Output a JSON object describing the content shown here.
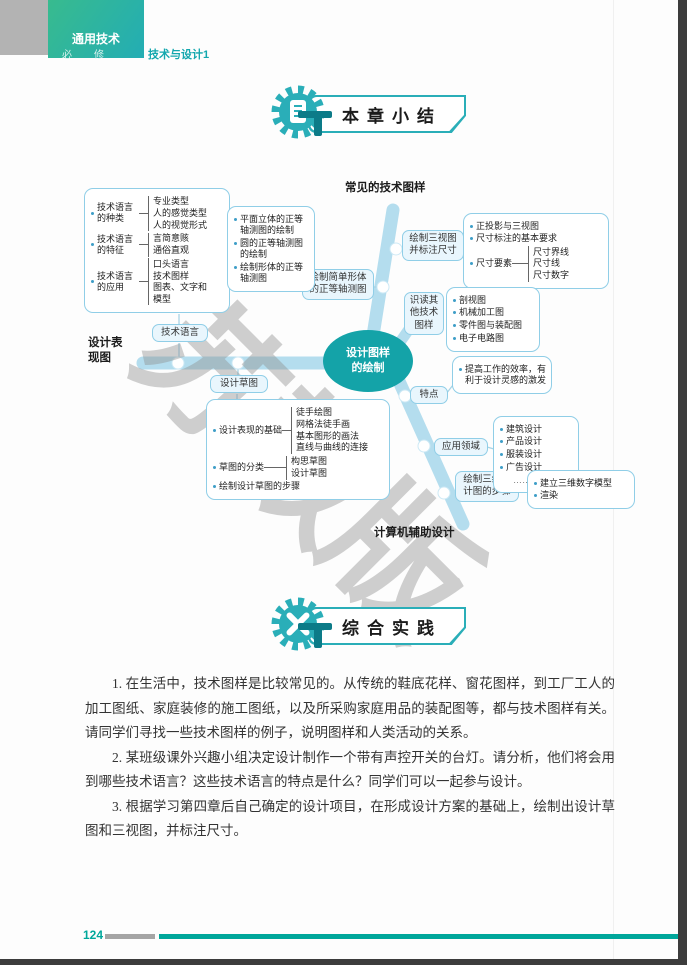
{
  "header": {
    "series": "通用技术",
    "level": "必　修",
    "book": "技术与设计1"
  },
  "badges": {
    "summary": "本章小结",
    "practice": "综合实践"
  },
  "mindmap": {
    "center_line1": "设计图样",
    "center_line2": "的绘制",
    "watermark": "苏教版",
    "labels": {
      "top": "常见的技术图样",
      "left": "设计表现图",
      "bottom": "计算机辅助设计"
    },
    "nodes": {
      "tech_language": "技术语言",
      "sketch": "设计草图",
      "simple_axono": "绘制简单形体的正等轴测图",
      "three_view": "绘制三视图并标注尺寸",
      "read_other": "识读其他技术图样",
      "features": "特点",
      "fields": "应用领域",
      "three_d": "绘制三维设计图的步骤"
    },
    "boxes": {
      "tech_language": {
        "items": [
          {
            "label": "技术语言的种类",
            "subs": [
              "专业类型",
              "人的感觉类型",
              "人的视觉形式"
            ]
          },
          {
            "label": "技术语言的特征",
            "subs": [
              "言简意赅",
              "通俗直观"
            ]
          },
          {
            "label": "技术语言的应用",
            "subs": [
              "口头语言",
              "技术图样",
              "图表、文字和模型"
            ]
          }
        ]
      },
      "axono": {
        "lines": [
          "平面立体的正等轴测图的绘制",
          "圆的正等轴测图的绘制",
          "绘制形体的正等轴测图"
        ]
      },
      "three_view": {
        "lines": [
          "正投影与三视图",
          "尺寸标注的基本要求"
        ],
        "item": {
          "label": "尺寸要素",
          "subs": [
            "尺寸界线",
            "尺寸线",
            "尺寸数字"
          ]
        }
      },
      "other_drawings": {
        "lines": [
          "剖视图",
          "机械加工图",
          "零件图与装配图",
          "电子电路图"
        ]
      },
      "features": {
        "lines": [
          "提高工作的效率，有利于设计灵感的激发"
        ]
      },
      "fields": {
        "lines": [
          "建筑设计",
          "产品设计",
          "服装设计",
          "广告设计"
        ],
        "more": "……"
      },
      "three_d": {
        "lines": [
          "建立三维数字模型",
          "渲染"
        ]
      },
      "sketch": {
        "items": [
          {
            "label": "设计表现的基础",
            "subs": [
              "徒手绘图",
              "网格法徒手画",
              "基本图形的画法",
              "直线与曲线的连接"
            ]
          },
          {
            "label": "草图的分类",
            "subs": [
              "构思草图",
              "设计草图"
            ]
          }
        ],
        "lines": [
          "绘制设计草图的步骤"
        ]
      }
    }
  },
  "practice": {
    "questions": [
      "1. 在生活中，技术图样是比较常见的。从传统的鞋底花样、窗花图样，到工厂工人的加工图纸、家庭装修的施工图纸，以及所采购家庭用品的装配图等，都与技术图样有关。请同学们寻找一些技术图样的例子，说明图样和人类活动的关系。",
      "2. 某班级课外兴趣小组决定设计制作一个带有声控开关的台灯。请分析，他们将会用到哪些技术语言？这些技术语言的特点是什么？同学们可以一起参与设计。",
      "3. 根据学习第四章后自己确定的设计项目，在形成设计方案的基础上，绘制出设计草图和三视图，并标注尺寸。"
    ]
  },
  "footer": {
    "page_number": "124"
  }
}
